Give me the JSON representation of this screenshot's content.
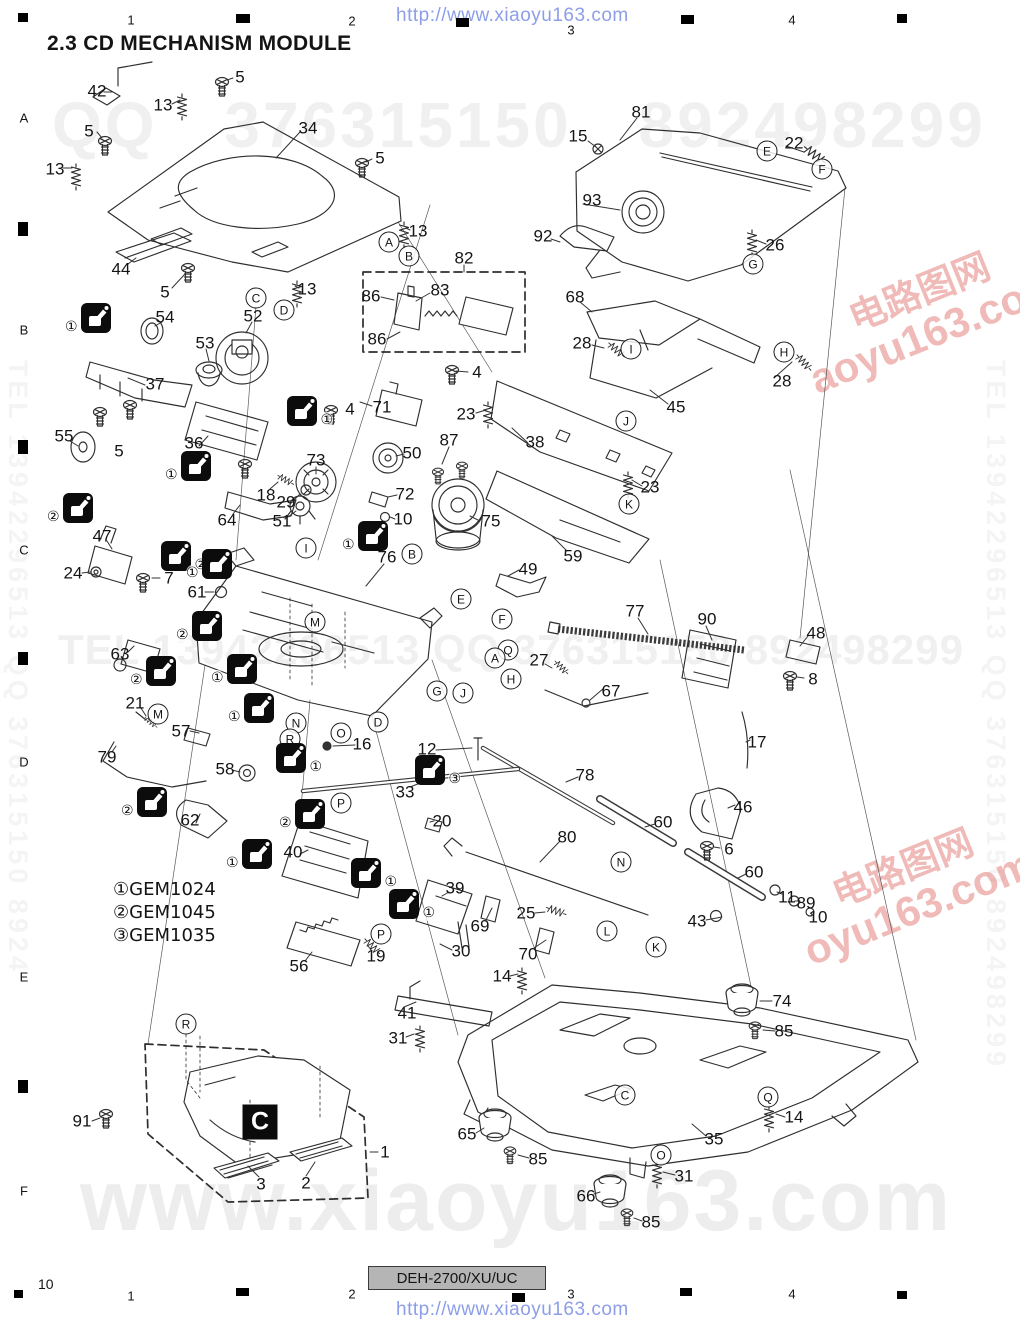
{
  "page": {
    "title": "2.3  CD MECHANISM MODULE"
  },
  "footer": {
    "page_number": "10",
    "model": "DEH-2700/XU/UC"
  },
  "watermarks": {
    "url_top": "http://www.xiaoyu163.com",
    "url_bottom": "http://www.xiaoyu163.com",
    "qq_line": "QQ 376315150  892498299",
    "tel_line": "TEL 13942296513 QQ 376315150 892498299",
    "site_line": "www.xiaoyu163.com",
    "side_left": "TEL 13942296513 QQ 376315150 8924",
    "side_right": "TEL 13942296513 QQ 376315150 892498299",
    "red_cjk": "电路图网",
    "red_latin_1": "aoyu163.com",
    "red_latin_2": "oyu163.com",
    "colors": {
      "url": "#8d9ee8",
      "gray": "#f0f0f0",
      "red": "#e2837e"
    }
  },
  "grid": {
    "top": [
      {
        "t": "1",
        "x": 131,
        "y": 20
      },
      {
        "t": "2",
        "x": 352,
        "y": 21
      },
      {
        "t": "3",
        "x": 571,
        "y": 30
      },
      {
        "t": "4",
        "x": 792,
        "y": 20
      }
    ],
    "bottom": [
      {
        "t": "1",
        "x": 131,
        "y": 1296
      },
      {
        "t": "2",
        "x": 352,
        "y": 1294
      },
      {
        "t": "3",
        "x": 571,
        "y": 1294
      },
      {
        "t": "4",
        "x": 792,
        "y": 1294
      }
    ],
    "left": [
      {
        "t": "A",
        "y": 118
      },
      {
        "t": "B",
        "y": 330
      },
      {
        "t": "C",
        "y": 550
      },
      {
        "t": "D",
        "y": 762
      },
      {
        "t": "E",
        "y": 977
      },
      {
        "t": "F",
        "y": 1191
      }
    ]
  },
  "print_marks": [
    {
      "x": 18,
      "y": 13,
      "w": 10,
      "h": 9
    },
    {
      "x": 236,
      "y": 14,
      "w": 14,
      "h": 9
    },
    {
      "x": 456,
      "y": 18,
      "w": 13,
      "h": 9
    },
    {
      "x": 681,
      "y": 15,
      "w": 13,
      "h": 9
    },
    {
      "x": 897,
      "y": 14,
      "w": 10,
      "h": 9
    },
    {
      "x": 18,
      "y": 222,
      "w": 10,
      "h": 14
    },
    {
      "x": 18,
      "y": 440,
      "w": 10,
      "h": 14
    },
    {
      "x": 18,
      "y": 652,
      "w": 10,
      "h": 13
    },
    {
      "x": 18,
      "y": 1080,
      "w": 10,
      "h": 13
    },
    {
      "x": 14,
      "y": 1290,
      "w": 9,
      "h": 8
    },
    {
      "x": 236,
      "y": 1288,
      "w": 13,
      "h": 8
    },
    {
      "x": 512,
      "y": 1293,
      "w": 13,
      "h": 9
    },
    {
      "x": 680,
      "y": 1288,
      "w": 12,
      "h": 8
    },
    {
      "x": 897,
      "y": 1291,
      "w": 10,
      "h": 8
    }
  ],
  "legend": {
    "items": [
      {
        "marker": "①",
        "code": "GEM1024"
      },
      {
        "marker": "②",
        "code": "GEM1045"
      },
      {
        "marker": "③",
        "code": "GEM1035"
      }
    ]
  },
  "diagram": {
    "board_label": {
      "t": "C",
      "x": 260,
      "y": 1122
    },
    "part_labels": [
      {
        "t": "42",
        "x": 97,
        "y": 91
      },
      {
        "t": "13",
        "x": 163,
        "y": 105
      },
      {
        "t": "5",
        "x": 240,
        "y": 77
      },
      {
        "t": "5",
        "x": 89,
        "y": 131
      },
      {
        "t": "13",
        "x": 55,
        "y": 169
      },
      {
        "t": "34",
        "x": 308,
        "y": 128
      },
      {
        "t": "5",
        "x": 380,
        "y": 158
      },
      {
        "t": "13",
        "x": 418,
        "y": 231
      },
      {
        "t": "44",
        "x": 121,
        "y": 269
      },
      {
        "t": "5",
        "x": 165,
        "y": 292
      },
      {
        "t": "13",
        "x": 307,
        "y": 289
      },
      {
        "t": "81",
        "x": 641,
        "y": 112
      },
      {
        "t": "15",
        "x": 578,
        "y": 136
      },
      {
        "t": "22",
        "x": 794,
        "y": 143
      },
      {
        "t": "93",
        "x": 592,
        "y": 200
      },
      {
        "t": "92",
        "x": 543,
        "y": 236
      },
      {
        "t": "26",
        "x": 775,
        "y": 245
      },
      {
        "t": "82",
        "x": 464,
        "y": 258
      },
      {
        "t": "86",
        "x": 371,
        "y": 296
      },
      {
        "t": "83",
        "x": 440,
        "y": 290
      },
      {
        "t": "86",
        "x": 377,
        "y": 339
      },
      {
        "t": "4",
        "x": 477,
        "y": 372
      },
      {
        "t": "71",
        "x": 382,
        "y": 407
      },
      {
        "t": "68",
        "x": 575,
        "y": 297
      },
      {
        "t": "28",
        "x": 582,
        "y": 343
      },
      {
        "t": "28",
        "x": 782,
        "y": 381
      },
      {
        "t": "45",
        "x": 676,
        "y": 407
      },
      {
        "t": "54",
        "x": 165,
        "y": 317
      },
      {
        "t": "52",
        "x": 253,
        "y": 316
      },
      {
        "t": "53",
        "x": 205,
        "y": 343
      },
      {
        "t": "37",
        "x": 155,
        "y": 384
      },
      {
        "t": "55",
        "x": 64,
        "y": 436
      },
      {
        "t": "5",
        "x": 119,
        "y": 451
      },
      {
        "t": "36",
        "x": 194,
        "y": 443
      },
      {
        "t": "4",
        "x": 203,
        "y": 460
      },
      {
        "t": "4",
        "x": 350,
        "y": 409
      },
      {
        "t": "73",
        "x": 316,
        "y": 460
      },
      {
        "t": "50",
        "x": 412,
        "y": 453
      },
      {
        "t": "87",
        "x": 449,
        "y": 440
      },
      {
        "t": "18",
        "x": 266,
        "y": 495
      },
      {
        "t": "29",
        "x": 286,
        "y": 502
      },
      {
        "t": "64",
        "x": 227,
        "y": 520
      },
      {
        "t": "51",
        "x": 282,
        "y": 521
      },
      {
        "t": "72",
        "x": 405,
        "y": 494
      },
      {
        "t": "10",
        "x": 403,
        "y": 519
      },
      {
        "t": "75",
        "x": 491,
        "y": 521
      },
      {
        "t": "23",
        "x": 466,
        "y": 414
      },
      {
        "t": "38",
        "x": 535,
        "y": 442
      },
      {
        "t": "23",
        "x": 650,
        "y": 487
      },
      {
        "t": "59",
        "x": 573,
        "y": 556
      },
      {
        "t": "47",
        "x": 102,
        "y": 536
      },
      {
        "t": "24",
        "x": 73,
        "y": 573
      },
      {
        "t": "7",
        "x": 169,
        "y": 578
      },
      {
        "t": "61",
        "x": 197,
        "y": 592
      },
      {
        "t": "76",
        "x": 387,
        "y": 557
      },
      {
        "t": "49",
        "x": 528,
        "y": 569
      },
      {
        "t": "63",
        "x": 120,
        "y": 654
      },
      {
        "t": "27",
        "x": 539,
        "y": 660
      },
      {
        "t": "77",
        "x": 635,
        "y": 611
      },
      {
        "t": "90",
        "x": 707,
        "y": 619
      },
      {
        "t": "48",
        "x": 816,
        "y": 633
      },
      {
        "t": "8",
        "x": 813,
        "y": 679
      },
      {
        "t": "67",
        "x": 611,
        "y": 691
      },
      {
        "t": "17",
        "x": 757,
        "y": 742
      },
      {
        "t": "46",
        "x": 743,
        "y": 807
      },
      {
        "t": "6",
        "x": 729,
        "y": 849
      },
      {
        "t": "78",
        "x": 585,
        "y": 775
      },
      {
        "t": "60",
        "x": 663,
        "y": 822
      },
      {
        "t": "60",
        "x": 754,
        "y": 872
      },
      {
        "t": "11",
        "x": 787,
        "y": 897
      },
      {
        "t": "89",
        "x": 806,
        "y": 903
      },
      {
        "t": "10",
        "x": 818,
        "y": 917
      },
      {
        "t": "80",
        "x": 567,
        "y": 837
      },
      {
        "t": "25",
        "x": 526,
        "y": 913
      },
      {
        "t": "43",
        "x": 697,
        "y": 921
      },
      {
        "t": "69",
        "x": 480,
        "y": 926
      },
      {
        "t": "70",
        "x": 528,
        "y": 954
      },
      {
        "t": "21",
        "x": 135,
        "y": 703
      },
      {
        "t": "57",
        "x": 181,
        "y": 731
      },
      {
        "t": "79",
        "x": 107,
        "y": 757
      },
      {
        "t": "58",
        "x": 225,
        "y": 769
      },
      {
        "t": "16",
        "x": 362,
        "y": 744
      },
      {
        "t": "12",
        "x": 427,
        "y": 749
      },
      {
        "t": "33",
        "x": 405,
        "y": 792
      },
      {
        "t": "62",
        "x": 190,
        "y": 820
      },
      {
        "t": "40",
        "x": 293,
        "y": 852
      },
      {
        "t": "20",
        "x": 442,
        "y": 821
      },
      {
        "t": "39",
        "x": 455,
        "y": 888
      },
      {
        "t": "19",
        "x": 376,
        "y": 956
      },
      {
        "t": "30",
        "x": 461,
        "y": 951
      },
      {
        "t": "56",
        "x": 299,
        "y": 966
      },
      {
        "t": "41",
        "x": 407,
        "y": 1013
      },
      {
        "t": "14",
        "x": 502,
        "y": 976
      },
      {
        "t": "31",
        "x": 398,
        "y": 1038
      },
      {
        "t": "74",
        "x": 782,
        "y": 1001
      },
      {
        "t": "85",
        "x": 784,
        "y": 1031
      },
      {
        "t": "65",
        "x": 467,
        "y": 1134
      },
      {
        "t": "85",
        "x": 538,
        "y": 1159
      },
      {
        "t": "31",
        "x": 684,
        "y": 1176
      },
      {
        "t": "66",
        "x": 586,
        "y": 1196
      },
      {
        "t": "85",
        "x": 651,
        "y": 1222
      },
      {
        "t": "35",
        "x": 714,
        "y": 1139
      },
      {
        "t": "14",
        "x": 794,
        "y": 1117
      },
      {
        "t": "91",
        "x": 82,
        "y": 1121
      },
      {
        "t": "1",
        "x": 385,
        "y": 1152
      },
      {
        "t": "3",
        "x": 261,
        "y": 1184
      },
      {
        "t": "2",
        "x": 306,
        "y": 1183
      }
    ],
    "callouts": [
      {
        "t": "A",
        "x": 389,
        "y": 242
      },
      {
        "t": "B",
        "x": 409,
        "y": 256
      },
      {
        "t": "C",
        "x": 256,
        "y": 298
      },
      {
        "t": "D",
        "x": 284,
        "y": 310
      },
      {
        "t": "E",
        "x": 767,
        "y": 151
      },
      {
        "t": "F",
        "x": 822,
        "y": 169
      },
      {
        "t": "G",
        "x": 753,
        "y": 264
      },
      {
        "t": "I",
        "x": 631,
        "y": 349
      },
      {
        "t": "H",
        "x": 784,
        "y": 352
      },
      {
        "t": "J",
        "x": 626,
        "y": 421
      },
      {
        "t": "K",
        "x": 629,
        "y": 504
      },
      {
        "t": "I",
        "x": 306,
        "y": 548
      },
      {
        "t": "B",
        "x": 412,
        "y": 554
      },
      {
        "t": "E",
        "x": 461,
        "y": 599
      },
      {
        "t": "F",
        "x": 502,
        "y": 619
      },
      {
        "t": "M",
        "x": 315,
        "y": 622
      },
      {
        "t": "Q",
        "x": 508,
        "y": 650
      },
      {
        "t": "A",
        "x": 495,
        "y": 658
      },
      {
        "t": "H",
        "x": 511,
        "y": 679
      },
      {
        "t": "G",
        "x": 437,
        "y": 691
      },
      {
        "t": "J",
        "x": 463,
        "y": 693
      },
      {
        "t": "M",
        "x": 158,
        "y": 714
      },
      {
        "t": "N",
        "x": 296,
        "y": 723
      },
      {
        "t": "R",
        "x": 290,
        "y": 739
      },
      {
        "t": "O",
        "x": 341,
        "y": 733
      },
      {
        "t": "D",
        "x": 378,
        "y": 722
      },
      {
        "t": "P",
        "x": 341,
        "y": 803
      },
      {
        "t": "N",
        "x": 621,
        "y": 862
      },
      {
        "t": "L",
        "x": 607,
        "y": 931
      },
      {
        "t": "K",
        "x": 656,
        "y": 947
      },
      {
        "t": "P",
        "x": 381,
        "y": 934
      },
      {
        "t": "R",
        "x": 186,
        "y": 1024
      },
      {
        "t": "C",
        "x": 625,
        "y": 1095
      },
      {
        "t": "Q",
        "x": 768,
        "y": 1097
      },
      {
        "t": "O",
        "x": 661,
        "y": 1155
      }
    ],
    "lube_icons": [
      {
        "m": "①",
        "x": 96,
        "y": 318,
        "s": "l"
      },
      {
        "m": "①",
        "x": 302,
        "y": 411,
        "s": "r"
      },
      {
        "m": "①",
        "x": 196,
        "y": 466,
        "s": "l"
      },
      {
        "m": "②",
        "x": 78,
        "y": 508,
        "s": "l"
      },
      {
        "m": "②",
        "x": 176,
        "y": 556,
        "s": "r"
      },
      {
        "m": "①",
        "x": 217,
        "y": 564,
        "s": "l"
      },
      {
        "m": "①",
        "x": 373,
        "y": 536,
        "s": "l"
      },
      {
        "m": "②",
        "x": 207,
        "y": 626,
        "s": "l"
      },
      {
        "m": "②",
        "x": 161,
        "y": 671,
        "s": "l"
      },
      {
        "m": "①",
        "x": 242,
        "y": 669,
        "s": "l"
      },
      {
        "m": "①",
        "x": 259,
        "y": 708,
        "s": "l"
      },
      {
        "m": "①",
        "x": 291,
        "y": 758,
        "s": "r"
      },
      {
        "m": "③",
        "x": 430,
        "y": 770,
        "s": "r"
      },
      {
        "m": "②",
        "x": 152,
        "y": 802,
        "s": "l"
      },
      {
        "m": "②",
        "x": 310,
        "y": 814,
        "s": "l"
      },
      {
        "m": "①",
        "x": 257,
        "y": 854,
        "s": "l"
      },
      {
        "m": "①",
        "x": 366,
        "y": 873,
        "s": "r"
      },
      {
        "m": "①",
        "x": 404,
        "y": 904,
        "s": "r"
      }
    ]
  }
}
